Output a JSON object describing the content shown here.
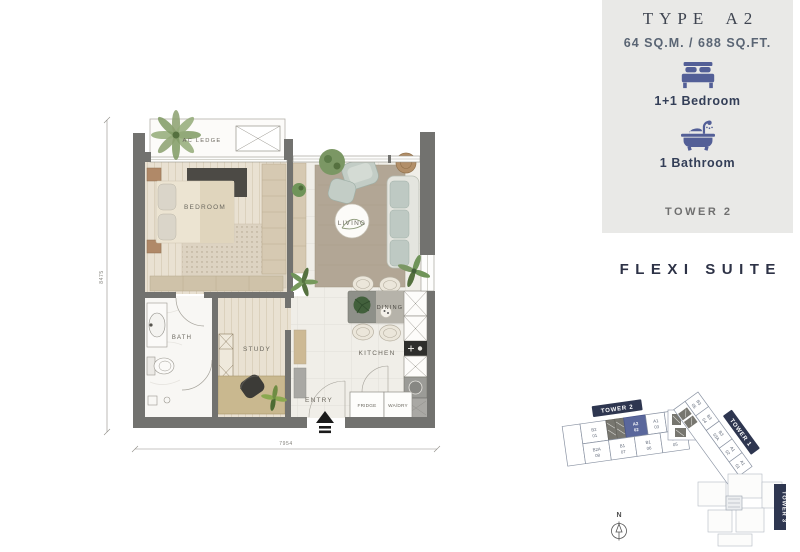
{
  "panel": {
    "title": "TYPE A2",
    "area": "64 SQ.M. / 688 SQ.FT.",
    "features": [
      {
        "icon": "bed-icon",
        "label": "1+1 Bedroom"
      },
      {
        "icon": "bathtub-icon",
        "label": "1 Bathroom"
      }
    ],
    "tower": "TOWER 2"
  },
  "suite_name": "FLEXI SUITE",
  "plan": {
    "rooms": {
      "ac_ledge": "AC LEDGE",
      "bedroom": "BEDROOM",
      "living": "LIVING",
      "bath": "BATH",
      "study": "STUDY",
      "dining": "DINING",
      "kitchen": "KITCHEN",
      "entry": "ENTRY",
      "fridge": "FRIDGE",
      "washer_dryer": "WA/DRY"
    },
    "dimensions": {
      "height_mm": "8475",
      "width_mm": "7954"
    }
  },
  "keyplan": {
    "compass": "N",
    "towers": {
      "t1": "TOWER 1",
      "t2": "TOWER 2",
      "t3": "TOWER 3"
    },
    "highlighted_unit": {
      "t": "A2",
      "n": "02"
    },
    "t2_top": [
      {
        "t": "A2",
        "n": "02"
      },
      {
        "t": "A1",
        "n": "03"
      },
      {
        "t": "A1",
        "n": "03A"
      }
    ],
    "t2_left": [
      {
        "t": "B2",
        "n": "01"
      },
      {
        "t": "B2A",
        "n": "08"
      }
    ],
    "t2_bottom": [
      {
        "t": "B1",
        "n": "07"
      },
      {
        "t": "B1",
        "n": "06"
      },
      {
        "t": "B1",
        "n": "05"
      }
    ],
    "t1_units": [
      {
        "t": "B3",
        "n": "05"
      },
      {
        "t": "B3",
        "n": "04"
      },
      {
        "t": "B3",
        "n": "03A"
      },
      {
        "t": "A1",
        "n": "02"
      },
      {
        "t": "A1",
        "n": "01"
      }
    ]
  },
  "colors": {
    "accent_blue": "#5a679c",
    "navy": "#2e3650",
    "panel_bg": "#e9e9e7",
    "wall_gray": "#72726f"
  }
}
